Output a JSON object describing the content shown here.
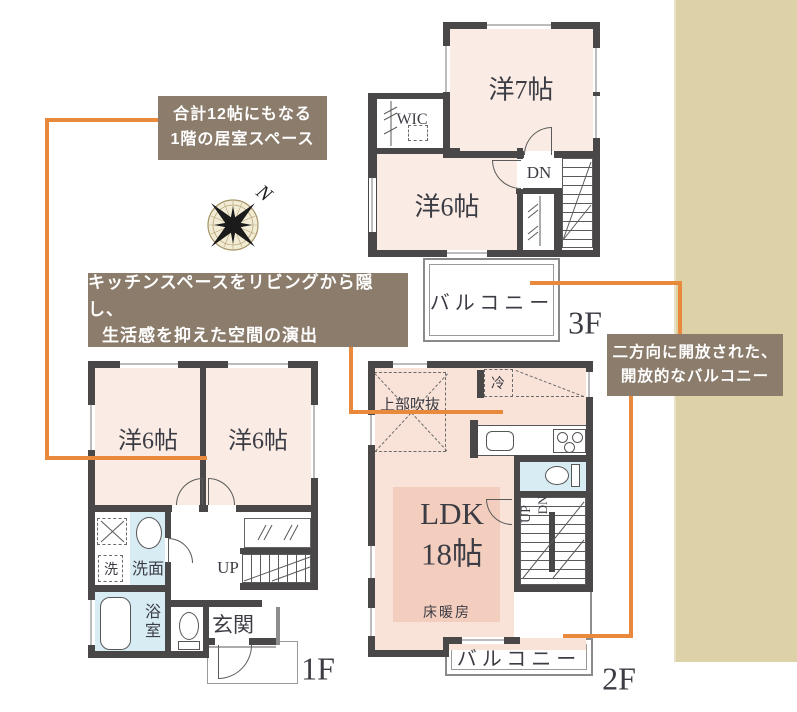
{
  "theme": {
    "accent": "#e8893c",
    "stripe": "#ddd2a7",
    "note": "#8b7c6b",
    "wall": "#494747",
    "room": "#faece4",
    "ldk": "#f9e3d9",
    "heat": "#f3cebf",
    "wet": "#d8ecf4",
    "ink": "#3c3c44"
  },
  "notes": {
    "rooms_1f": {
      "line1": "合計12帖にもなる",
      "line2": "1階の居室スペース"
    },
    "kitchen": {
      "line1": "キッチンスペースをリビングから隠し、",
      "line2": "生活感を抑えた空間の演出"
    },
    "balcony": {
      "line1": "二方向に開放された、",
      "line2": "開放的なバルコニー"
    }
  },
  "compass": {
    "north": "N"
  },
  "floor3": {
    "label": "3F",
    "room7": "洋7帖",
    "wic": "WIC",
    "room6": "洋6帖",
    "dn": "DN",
    "balcony": "バルコニー"
  },
  "floor2": {
    "label": "2F",
    "ldk": "LDK",
    "ldk_size": "18帖",
    "void_above": "上部吹抜",
    "fridge": "冷",
    "floor_heating": "床暖房",
    "up": "UP",
    "dn": "DN",
    "balcony": "バルコニー"
  },
  "floor1": {
    "label": "1F",
    "room6a": "洋6帖",
    "room6b": "洋6帖",
    "washer": "洗",
    "washroom": "洗面",
    "bath": "浴室",
    "entrance": "玄関",
    "up": "UP"
  }
}
